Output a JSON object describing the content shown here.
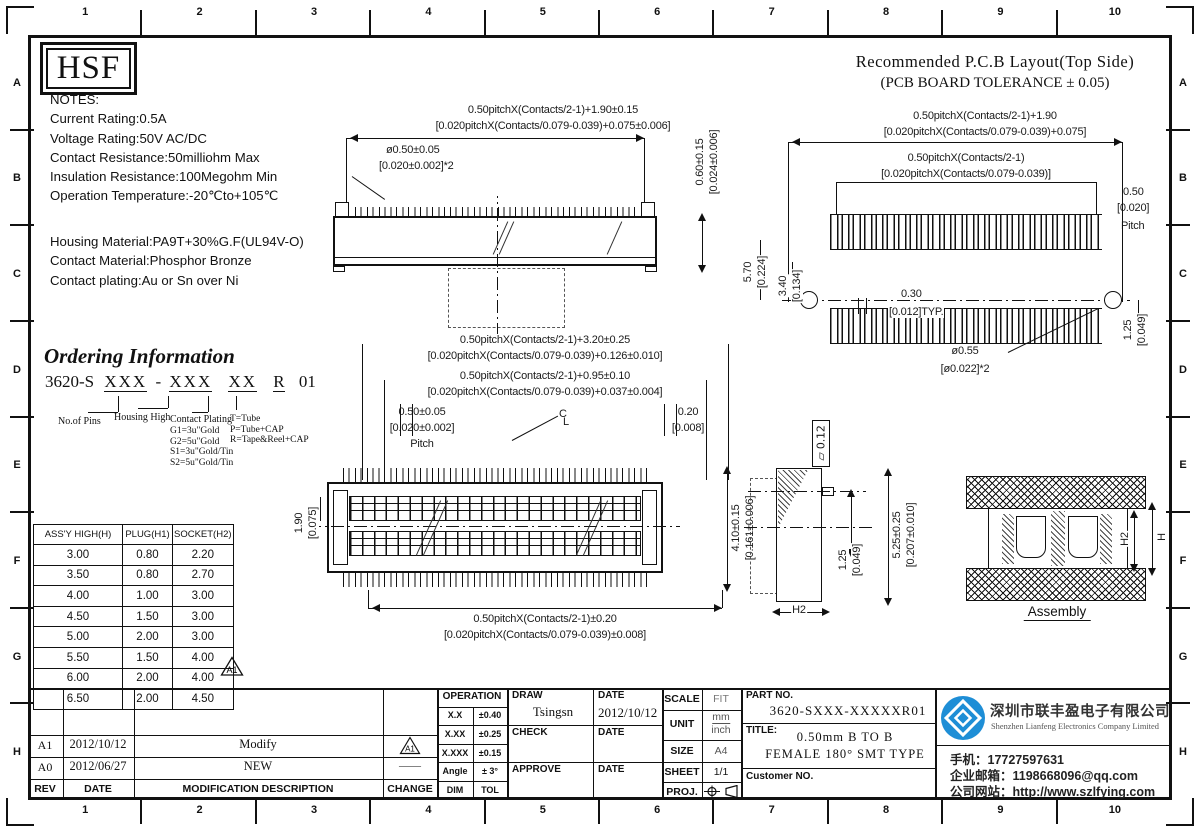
{
  "frame": {
    "top_numbers": [
      "1",
      "2",
      "3",
      "4",
      "5",
      "6",
      "7",
      "8",
      "9",
      "10"
    ],
    "side_letters": [
      "A",
      "B",
      "C",
      "D",
      "E",
      "F",
      "G",
      "H"
    ]
  },
  "logo_text": "HSF",
  "notes": {
    "lines": [
      "NOTES:",
      "Current Rating:0.5A",
      "Voltage Rating:50V AC/DC",
      "Contact Resistance:50milliohm Max",
      "Insulation Resistance:100Megohm Min",
      "Operation Temperature:-20℃to+105℃"
    ],
    "lines2": [
      "Housing Material:PA9T+30%G.F(UL94V-O)",
      "Contact Material:Phosphor Bronze",
      "Contact plating:Au or Sn over Ni"
    ]
  },
  "pcb": {
    "title1": "Recommended P.C.B Layout(Top Side)",
    "title2": "(PCB BOARD TOLERANCE ± 0.05)",
    "dim1a": "0.50pitchX(Contacts/2-1)+1.90",
    "dim1b": "[0.020pitchX(Contacts/0.079-0.039)+0.075]",
    "dim2a": "0.50pitchX(Contacts/2-1)",
    "dim2b": "[0.020pitchX(Contacts/0.079-0.039)]",
    "pitch_a": "0.50",
    "pitch_b": "[0.020]",
    "pitch_c": "Pitch",
    "d570": "5.70",
    "d570b": "[0.224]",
    "d340": "3.40",
    "d340b": "[0.134]",
    "d030": "0.30",
    "d030b": "[0.012]TYP.",
    "hole1": "ø0.55",
    "hole2": "[ø0.022]*2",
    "d125": "1.25",
    "d125b": "[0.049]"
  },
  "top_view": {
    "dim_l1": "0.50pitchX(Contacts/2-1)+1.90±0.15",
    "dim_l2": "[0.020pitchX(Contacts/0.079-0.039)+0.075±0.006]",
    "dim_hole1": "ø0.50±0.05",
    "dim_hole2": "[0.020±0.002]*2",
    "dim_v1": "0.60±0.15",
    "dim_v2": "[0.024±0.006]"
  },
  "mid_dims": {
    "l1": "0.50pitchX(Contacts/2-1)+3.20±0.25",
    "l2": "[0.020pitchX(Contacts/0.079-0.039)+0.126±0.010]",
    "l3": "0.50pitchX(Contacts/2-1)+0.95±0.10",
    "l4": "[0.020pitchX(Contacts/0.079-0.039)+0.037±0.004]",
    "p1": "0.50±0.05",
    "p2": "[0.020±0.002]",
    "p3": "Pitch",
    "q1": "0.20",
    "q2": "[0.008]",
    "cl_c": "C",
    "cl_l": "L"
  },
  "front_view": {
    "left1": "1.90",
    "left2": "[0.075]",
    "right1": "4.10±0.15",
    "right2": "[0.161±0.006]",
    "bot1": "0.50pitchX(Contacts/2-1)±0.20",
    "bot2": "[0.020pitchX(Contacts/0.079-0.039)±0.008]"
  },
  "side_view": {
    "flag": "▱ 0.12",
    "d1": "1.25",
    "d1b": "[0.049]",
    "d2": "5.25±0.25",
    "d2b": "[0.207±0.010]",
    "h2": "H2"
  },
  "assembly": {
    "h": "H",
    "h2": "H2",
    "label": "Assembly"
  },
  "ordering": {
    "title": "Ordering Information",
    "pn_prefix": "3620-S",
    "g1": "XXX",
    "dash": "-",
    "g2": "XXX",
    "g3": "XX",
    "g4": "R",
    "suffix": "01",
    "lbl_pins": "No.of Pins",
    "lbl_housing": "Housing High",
    "lbl_plating": "Contact Plating",
    "plating": [
      "G1=3u\"Gold",
      "G2=5u\"Gold",
      "S1=3u\"Gold/Tin",
      "S2=5u\"Gold/Tin"
    ],
    "packing": [
      "T=Tube",
      "P=Tube+CAP",
      "R=Tape&Reel+CAP"
    ]
  },
  "spec_table": {
    "headers": [
      "ASS'Y HIGH(H)",
      "PLUG(H1)",
      "SOCKET(H2)"
    ],
    "rows": [
      [
        "3.00",
        "0.80",
        "2.20"
      ],
      [
        "3.50",
        "0.80",
        "2.70"
      ],
      [
        "4.00",
        "1.00",
        "3.00"
      ],
      [
        "4.50",
        "1.50",
        "3.00"
      ],
      [
        "5.00",
        "2.00",
        "3.00"
      ],
      [
        "5.50",
        "1.50",
        "4.00"
      ],
      [
        "6.00",
        "2.00",
        "4.00"
      ],
      [
        "6.50",
        "2.00",
        "4.50"
      ]
    ],
    "marker": "A1"
  },
  "revisions": {
    "h_rev": "REV",
    "h_date": "DATE",
    "h_desc": "MODIFICATION DESCRIPTION",
    "h_change": "CHANGE",
    "rows": [
      {
        "rev": "A1",
        "date": "2012/10/12",
        "desc": "Modify",
        "change": "A1"
      },
      {
        "rev": "A0",
        "date": "2012/06/27",
        "desc": "NEW",
        "change": "——"
      }
    ]
  },
  "operation": {
    "title": "OPERATION",
    "rows": [
      [
        "X.X",
        "±0.40"
      ],
      [
        "X.XX",
        "±0.25"
      ],
      [
        "X.XXX",
        "±0.15"
      ],
      [
        "Angle",
        "± 3°"
      ],
      [
        "DIM",
        "TOL"
      ]
    ]
  },
  "signoff": {
    "draw_label": "DRAW",
    "draw_name": "Tsingsn",
    "date_label1": "DATE",
    "draw_date": "2012/10/12",
    "check_label": "CHECK",
    "date_label2": "DATE",
    "approve_label": "APPROVE",
    "date_label3": "DATE"
  },
  "meta": {
    "scale_label": "SCALE",
    "scale": "FIT",
    "unit_label": "UNIT",
    "unit1": "mm",
    "unit2": "inch",
    "size_label": "SIZE",
    "size": "A4",
    "sheet_label": "SHEET",
    "sheet": "1/1",
    "proj_label": "PROJ."
  },
  "part": {
    "part_no_label": "PART NO.",
    "part_no": "3620-SXXX-XXXXXR01",
    "title_label": "TITLE:",
    "title1": "0.50mm B TO B",
    "title2": "FEMALE 180° SMT TYPE",
    "customer_label": "Customer NO."
  },
  "company": {
    "name": "深圳市联丰盈电子有限公司",
    "name_en": "Shenzhen Lianfeng Electronics Company Limited",
    "phone": "手机：17727597631",
    "email": "企业邮箱：1198668096@qq.com",
    "website": "公司网站：http://www.szlfying.com",
    "logo_color": "#1e8ed6"
  }
}
